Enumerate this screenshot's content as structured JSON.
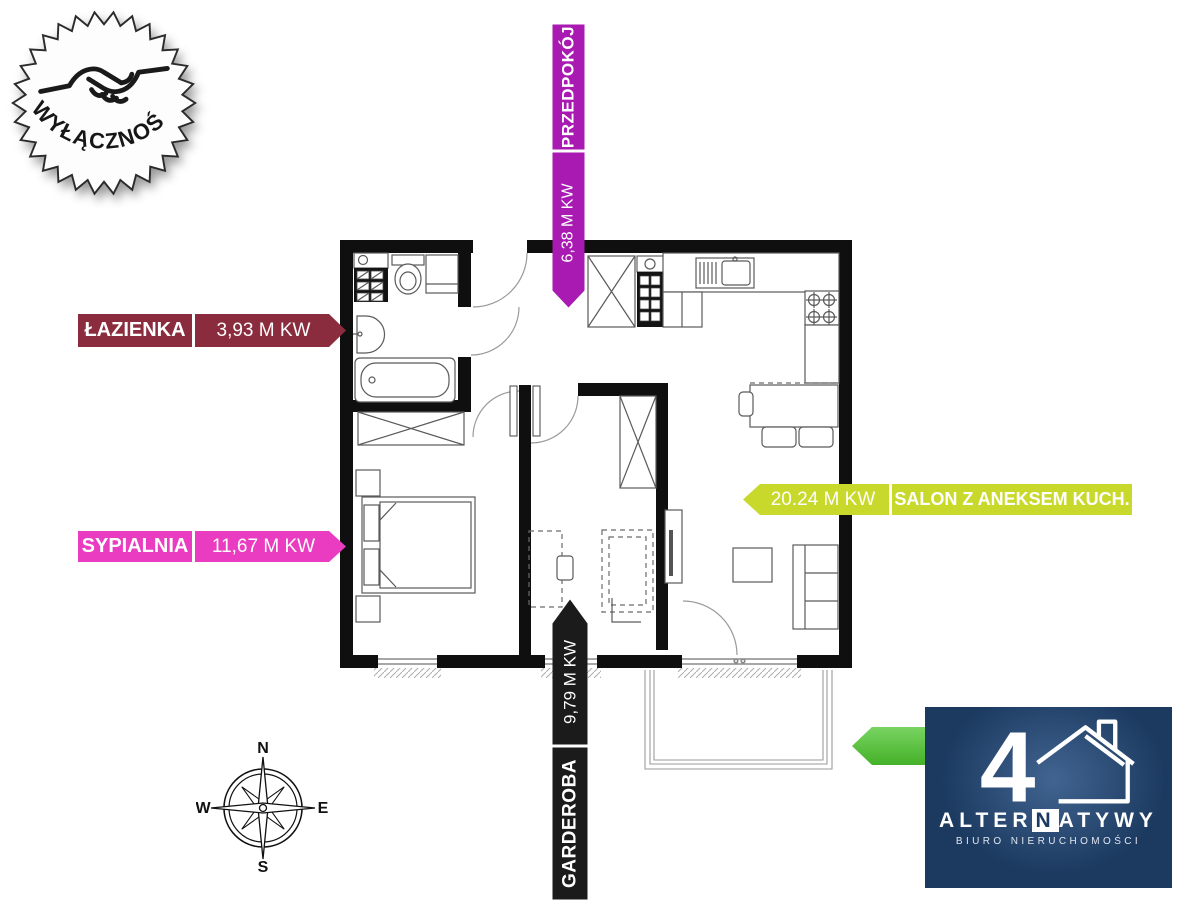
{
  "stamp": {
    "label": "WYŁĄCZNOŚĆ"
  },
  "plan_labels": {
    "przedpokoj": {
      "name": "PRZEDPOKÓJ",
      "area": "6,38 M KW",
      "color": "#a81ab2"
    },
    "lazienka": {
      "name": "ŁAZIENKA",
      "area": "3,93 M KW",
      "color": "#8b2c3e"
    },
    "sypialnia": {
      "name": "SYPIALNIA",
      "area": "11,67 M KW",
      "color": "#e93cc0"
    },
    "salon": {
      "name": "SALON Z ANEKSEM KUCH.",
      "area": "20.24 M KW",
      "color": "#c8d92b"
    },
    "garderoba": {
      "name": "GARDEROBA",
      "area": "9,79 M KW",
      "color": "#1b1b1b"
    }
  },
  "balcony_arrow": {
    "color": "#4cc52d"
  },
  "compass": {
    "north": "N",
    "south": "S",
    "east": "E",
    "west": "W"
  },
  "logo": {
    "numeral": "4",
    "name_pre": "ALTER",
    "name_mid": "N",
    "name_post": "ATYWY",
    "subtitle": "BIURO NIERUCHOMOŚCI",
    "bg_color": "#1c3a60"
  }
}
